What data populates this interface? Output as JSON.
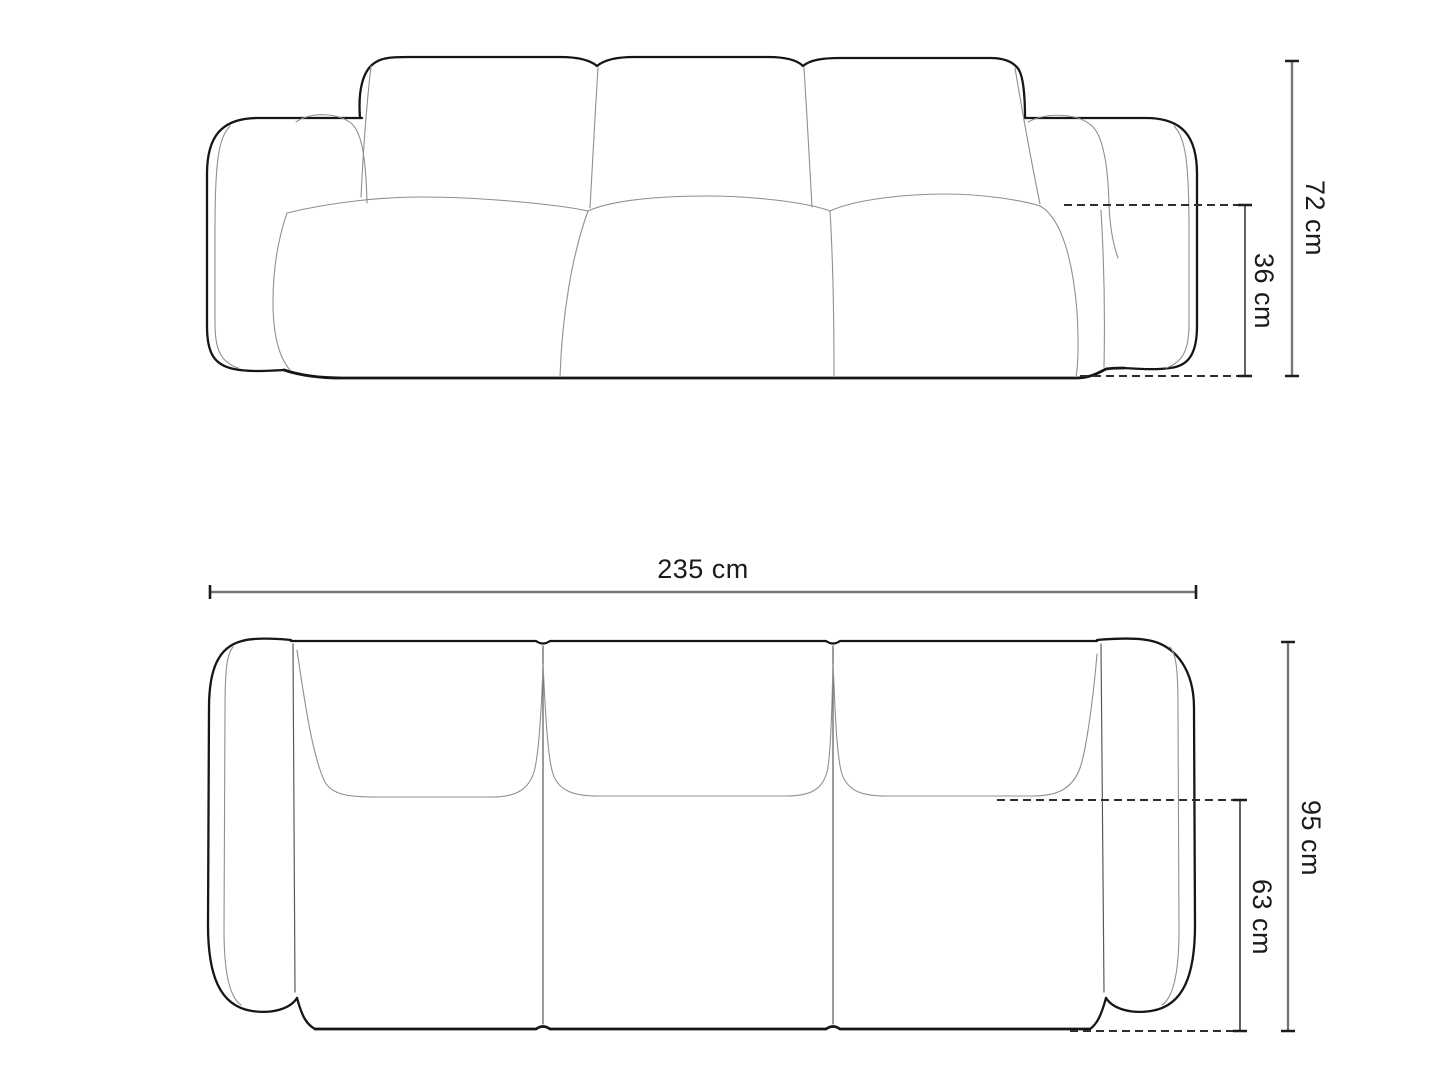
{
  "diagram": {
    "subject": "sofa-dimension-drawing",
    "front_view": {
      "total_height": "72 cm",
      "seat_height": "36 cm"
    },
    "top_view": {
      "total_width": "235 cm",
      "total_depth": "95 cm",
      "seat_depth": "63 cm"
    }
  },
  "colors": {
    "background": "#ffffff",
    "outline": "#161616",
    "seam": "#8f8f8f",
    "dimension_line": "#777777",
    "dashed_line": "#2e2e2e",
    "label_text": "#1b1b1b"
  }
}
